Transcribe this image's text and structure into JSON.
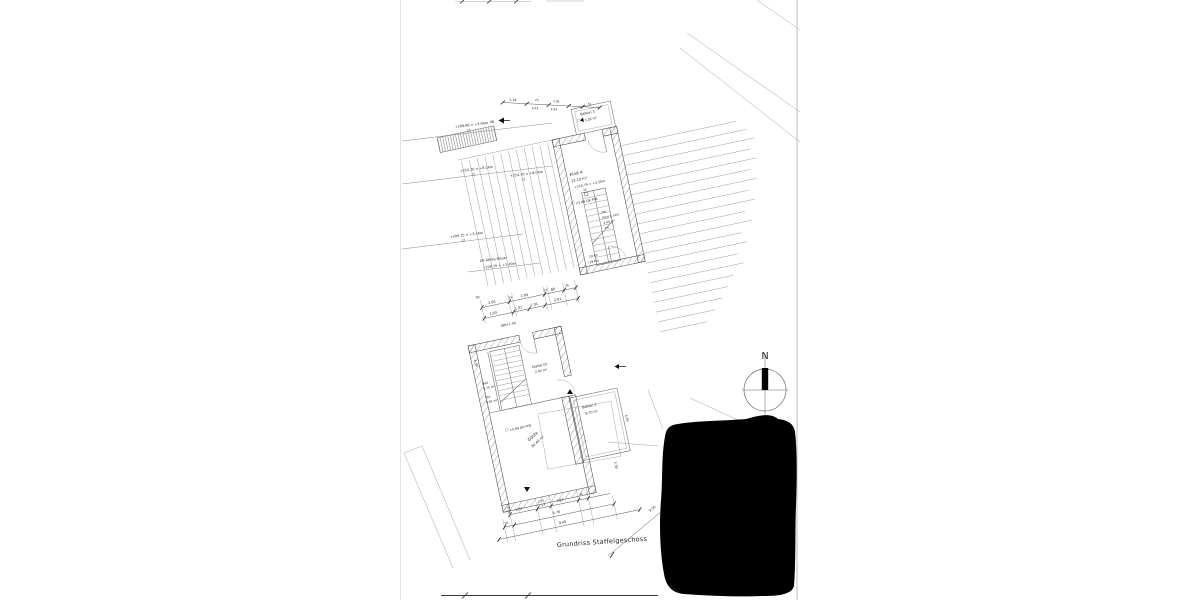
{
  "sheet": {
    "title": "Grundriss Staffelgeschoss"
  },
  "north": {
    "label": "N"
  },
  "rooms": {
    "balkon3": {
      "name": "Balkon 3",
      "area": "3.26 m²"
    },
    "kind4": {
      "name": "Kind 4",
      "area": "13.10 m²"
    },
    "treppe": {
      "l1": "2tb",
      "l2": "Kind 4 12st",
      "l3": "2.45 m²",
      "l4": "7m"
    },
    "speise": {
      "name": "Speise (o)",
      "area": "2.42 m²"
    },
    "bad": {
      "name": "Bad",
      "area": "0.75 m²"
    },
    "flur": {
      "name": "Flur",
      "area": "0.91 m²"
    },
    "gaeste": {
      "name": "Gäste",
      "area": "30.44 m²"
    },
    "balkon4": {
      "name": "Balkon 4",
      "area": "8.70 m²"
    }
  },
  "levels": {
    "e1": {
      "text": "+209.86 = +3.94m",
      "sub": "12"
    },
    "e2": {
      "text": "+214.30 = +8.04m",
      "sub": "12"
    },
    "e3": {
      "text": "+214.30 = +8.04m",
      "sub": "12"
    },
    "e4": {
      "text": "+209.75 = +3.49m",
      "sub": "12"
    },
    "attika": {
      "l1": "OK Attika Mauer",
      "l2": "+209.75 = +2.49m"
    },
    "innen": {
      "text": "+210.79 = +4.50m",
      "sub": "32"
    },
    "ffb_og": "+5.89 OK FFB",
    "ffb_eg": "+5.89 OK FFB",
    "mauer1": "19.60",
    "mauer2": "(19.60)",
    "marker": "98"
  },
  "dims": {
    "top": {
      "d1": "1.34",
      "d2": ".75",
      "d2h": "2.03",
      "d3": "1.01",
      "d3h": "2.03",
      "d4": "51"
    },
    "mitte1": [
      "2.00",
      "24",
      "1.99",
      "24",
      ".80",
      "36"
    ],
    "mitte2": [
      "1.93",
      "1.01",
      "1.01",
      "2.01"
    ],
    "brh": "BRH 1.00",
    "klein": "90",
    "links": "4.39",
    "unten1": {
      "d1": "1.87",
      "d2a": "1.26",
      "d2b": "1.33",
      "d3": "1.87",
      "d4": "36"
    },
    "unten2": {
      "d1": "36",
      "d2": "4.70"
    },
    "unten3": "9.45",
    "diag": "9.00",
    "vert": "2.36",
    "rechts1": "4.50",
    "rechts2": "2.30"
  }
}
